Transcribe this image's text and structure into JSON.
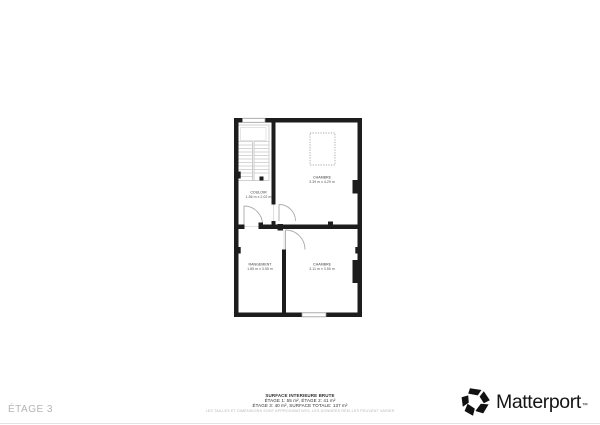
{
  "floor": {
    "label": "ÉTAGE 3"
  },
  "rooms": [
    {
      "name": "COULOIR",
      "dims": "1.56 m x 2.02 m"
    },
    {
      "name": "CHAMBRE",
      "dims": "3.39 m x 4.29 m"
    },
    {
      "name": "RANGEMENT",
      "dims": "1.85 m x 3.55 m"
    },
    {
      "name": "CHAMBRE",
      "dims": "3.11 m x 3.55 m"
    }
  ],
  "summary": {
    "title": "SURFACE INTERIEURE BRUTE",
    "line1": "ÉTAGE 1: 55 m², ÉTAGE 2: 41 m²",
    "line2": "ÉTAGE 3: 40 m², SURFACE TOTALE: 137 m²",
    "disclaimer": "LES TAILLES ET DIMENSIONS SONT APPROXIMATIVES, LES DONNÉES RÉELLES PEUVENT VARIER"
  },
  "branding": {
    "logo_text": "Matterport",
    "trademark": "™"
  },
  "colors": {
    "wall": "#1d1d1d",
    "stair_line": "#c6c6c6",
    "door_line": "#ababab",
    "label_text": "#3c3c3c",
    "muted_text": "#b4b4b4"
  }
}
